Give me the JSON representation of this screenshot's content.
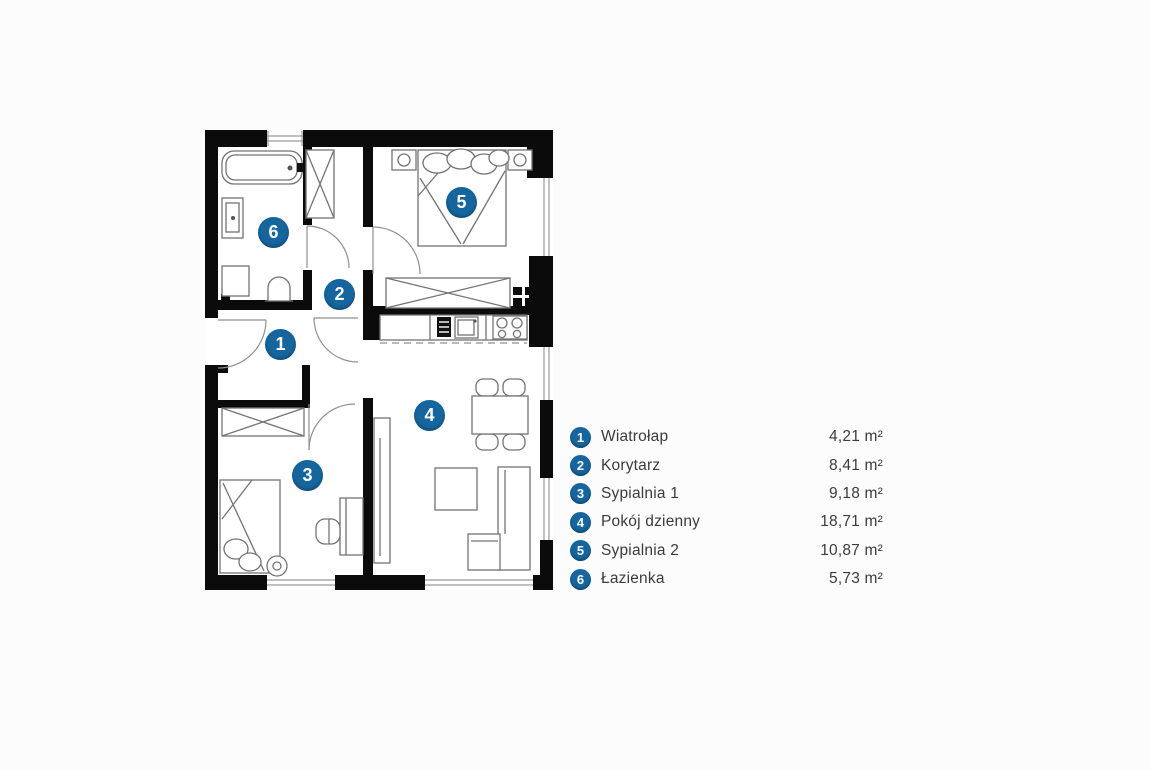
{
  "palette": {
    "accent_blue": "#15669f",
    "wall_black": "#0b0b0b",
    "furniture_gray": "#737373",
    "text_dark": "#3b3b3b",
    "background": "#fcfcfc"
  },
  "floor_plan": {
    "unit": "m²",
    "rooms": [
      {
        "number": "1",
        "label": "Wiatrołap",
        "area": "4,21 m²"
      },
      {
        "number": "2",
        "label": "Korytarz",
        "area": "8,41 m²"
      },
      {
        "number": "3",
        "label": "Sypialnia 1",
        "area": "9,18 m²"
      },
      {
        "number": "4",
        "label": "Pokój dzienny",
        "area": "18,71 m²"
      },
      {
        "number": "5",
        "label": "Sypialnia 2",
        "area": "10,87 m²"
      },
      {
        "number": "6",
        "label": "Łazienka",
        "area": "5,73 m²"
      }
    ]
  }
}
